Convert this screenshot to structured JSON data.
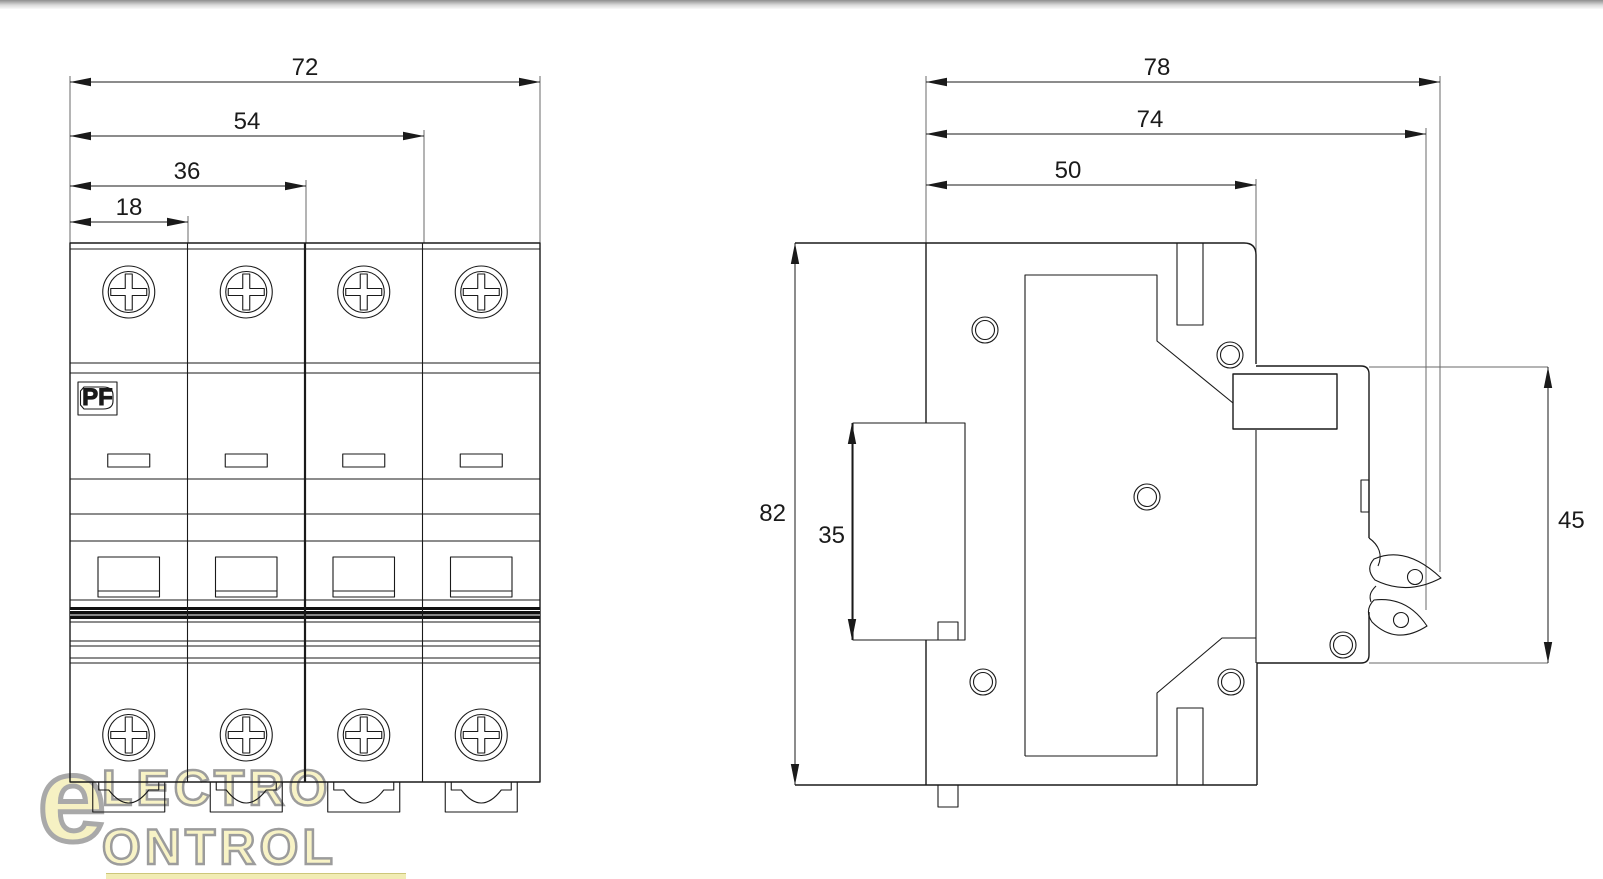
{
  "front_view": {
    "title": "front view 4-pole breaker",
    "dims": {
      "overall_width": "72",
      "three_modules": "54",
      "two_modules": "36",
      "one_module": "18"
    },
    "pf_label": "PF"
  },
  "side_view": {
    "title": "side view",
    "dims": {
      "depth_overall": "78",
      "depth_to_clip": "74",
      "depth_body": "50",
      "height_overall": "82",
      "din_channel": "35",
      "front_panel_height": "45"
    }
  },
  "watermark": {
    "symbol": "e",
    "line1": "LECTRO",
    "line2": "ONTROL"
  }
}
